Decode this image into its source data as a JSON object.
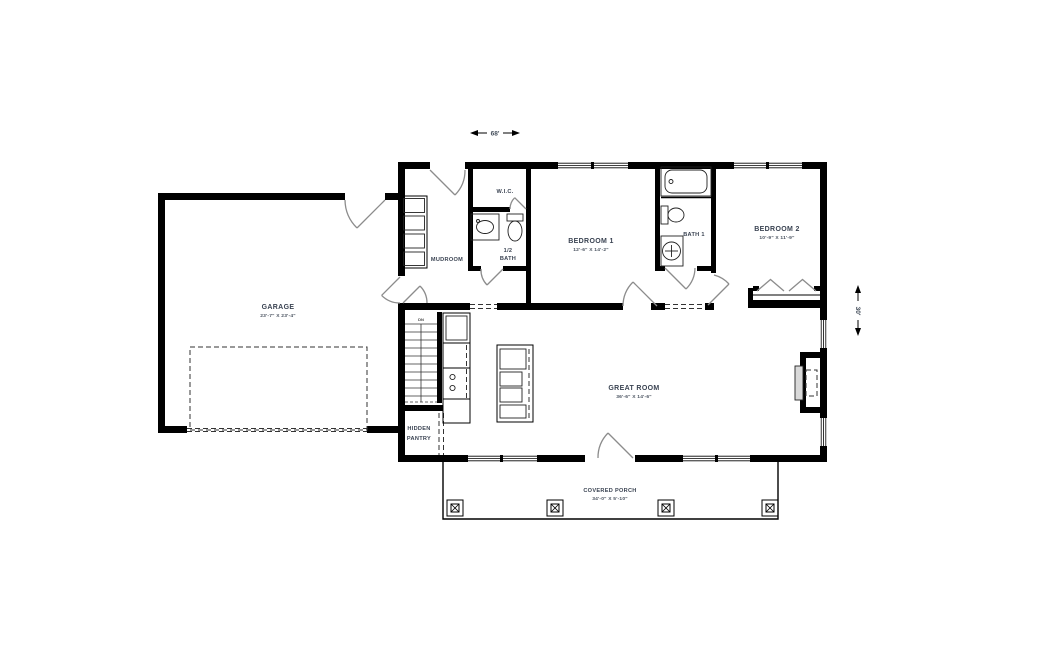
{
  "plan": {
    "overall_width_label": "68'",
    "overall_depth_label": "30'"
  },
  "rooms": {
    "garage": {
      "name": "GARAGE",
      "size": "23'-7\" X 23'-4\""
    },
    "mudroom": {
      "name": "MUDROOM"
    },
    "wic": {
      "name": "W.I.C."
    },
    "half_bath": {
      "line1": "1/2",
      "line2": "BATH"
    },
    "bedroom1": {
      "name": "BEDROOM 1",
      "size": "12'-6\" X 14'-2\""
    },
    "bath1": {
      "name": "BATH 1"
    },
    "bedroom2": {
      "name": "BEDROOM 2",
      "size": "10'-9\" X 11'-9\""
    },
    "great_room": {
      "name": "GREAT ROOM",
      "size": "36'-6\" X 14'-6\""
    },
    "hidden_pantry": {
      "line1": "HIDDEN",
      "line2": "PANTRY"
    },
    "covered_porch": {
      "name": "COVERED PORCH",
      "size": "34'-0\" X 5'-10\""
    },
    "stairs": {
      "label": "DN"
    }
  },
  "colors": {
    "wall": "#000000",
    "door_swing": "#8c8c8c",
    "label_text": "#3a4352",
    "background": "#ffffff"
  }
}
